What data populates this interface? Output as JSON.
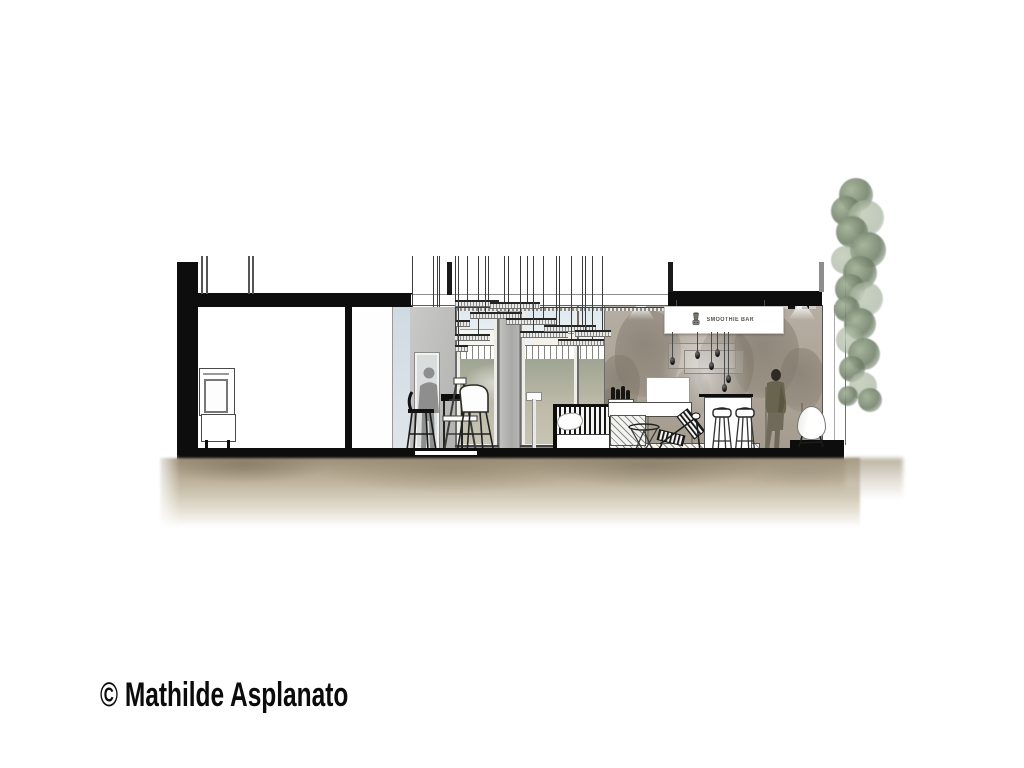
{
  "canvas": {
    "width": 1024,
    "height": 768,
    "background": "#ffffff"
  },
  "caption": {
    "text": "© Mathilde Asplanato",
    "color": "#0b0b0b"
  },
  "drawing": {
    "sign": {
      "text": "SMOOTHIE BAR",
      "icon": "blender-icon",
      "background": "#ffffff",
      "text_color": "#55524c"
    },
    "palette": {
      "ink": "#0d0d0d",
      "mural_base": "#b1a89b",
      "mural_tree": "#7d7568",
      "interior_gray_wall": "#bfbfbd",
      "sky": "#dce7ee",
      "exterior_ground": "#a3a894",
      "ground_wash_dark": "#9e9179",
      "ground_wash_light": "#cfc8b8",
      "foliage_green": "#7c8d76",
      "silhouette_gray": "#7d7d7d",
      "jacket_olive": "#68644d",
      "pants_brown": "#6f6a5a"
    },
    "decor": {
      "pendant_discs": [
        [
          400,
          336,
          44
        ],
        [
          424,
          320,
          46
        ],
        [
          442,
          334,
          48
        ],
        [
          455,
          300,
          44
        ],
        [
          470,
          312,
          52
        ],
        [
          490,
          302,
          50
        ],
        [
          506,
          318,
          50
        ],
        [
          520,
          331,
          48
        ],
        [
          544,
          325,
          52
        ],
        [
          558,
          339,
          46
        ],
        [
          575,
          330,
          36
        ],
        [
          428,
          345,
          40
        ]
      ],
      "hanging_bulbs": [
        [
          672,
          357
        ],
        [
          697,
          351
        ],
        [
          717,
          349
        ],
        [
          711,
          362
        ],
        [
          728,
          375
        ],
        [
          724,
          384
        ]
      ],
      "bottles": [
        [
          611,
          13
        ],
        [
          616,
          11
        ],
        [
          621,
          14
        ],
        [
          626,
          10
        ]
      ],
      "mural_trees": [
        [
          620,
          95,
          40
        ],
        [
          648,
          140,
          66
        ],
        [
          692,
          82,
          36
        ],
        [
          726,
          122,
          56
        ],
        [
          766,
          138,
          66
        ],
        [
          802,
          102,
          44
        ],
        [
          612,
          62,
          26
        ]
      ],
      "foliage": [
        [
          856,
          178,
          34
        ],
        [
          846,
          196,
          30
        ],
        [
          866,
          200,
          36
        ],
        [
          852,
          216,
          32
        ],
        [
          868,
          232,
          36
        ],
        [
          845,
          246,
          28
        ],
        [
          860,
          256,
          34
        ],
        [
          850,
          274,
          30
        ],
        [
          866,
          282,
          34
        ],
        [
          847,
          296,
          26
        ],
        [
          860,
          308,
          32
        ],
        [
          850,
          326,
          28
        ],
        [
          864,
          338,
          32
        ],
        [
          852,
          356,
          26
        ],
        [
          863,
          372,
          28
        ],
        [
          870,
          388,
          24
        ],
        [
          848,
          386,
          20
        ]
      ]
    }
  }
}
